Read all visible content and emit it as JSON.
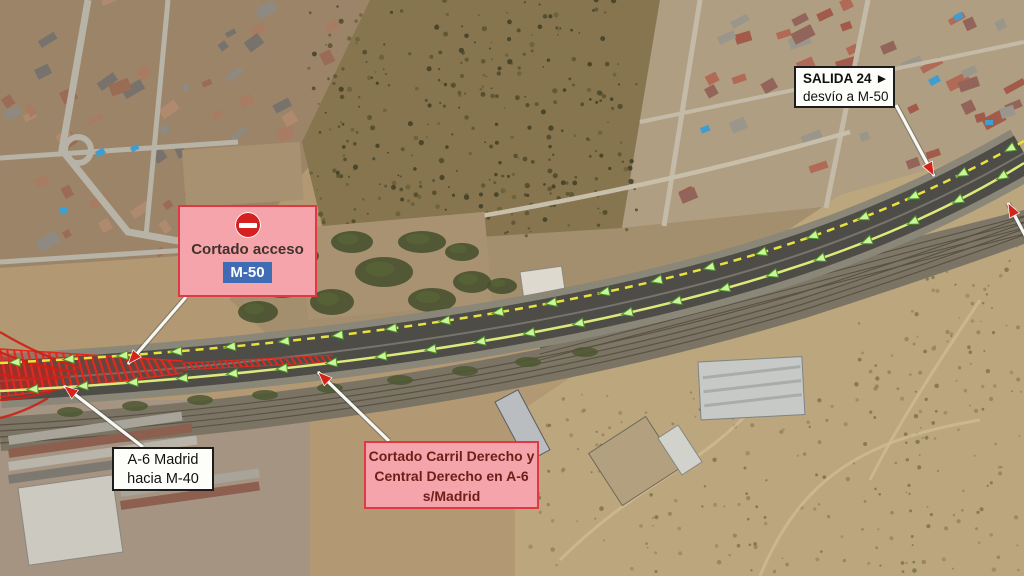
{
  "annotations": {
    "closed_access_box": {
      "icon": "no-entry-icon",
      "label": "Cortado acceso",
      "badge": "M-50"
    },
    "exit_box": {
      "line1": "SALIDA 24 ►",
      "line2": "desvío a M-50"
    },
    "a6_box": {
      "line1": "A-6 Madrid",
      "line2": "hacia M-40"
    },
    "lane_closure_box": {
      "line1": "Cortado Carril Derecho y",
      "line2": "Central Derecho en A-6",
      "line3": "s/Madrid"
    }
  },
  "colors": {
    "closure_box_bg": "#f4a4aa",
    "closure_box_border": "#dd3a44",
    "lane_closure_text": "#6d2019",
    "closed_access_text": "#41322c",
    "badge_bg": "#3f6cb5",
    "badge_text": "#ffffff",
    "no_entry_red": "#d61f1f",
    "route_dashed": "#e8e23c",
    "route_solid": "#dcea7c",
    "route_arrow_fill": "#c9f59b",
    "route_arrow_stroke": "#4e9428",
    "closed_lane_red": "#e02a20",
    "pointer_shaft": "#f7f7f4",
    "pointer_head": "#d42318",
    "white_box_bg": "#fdfdfa",
    "white_box_border": "#1c1c1c",
    "white_box_text": "#111111"
  }
}
